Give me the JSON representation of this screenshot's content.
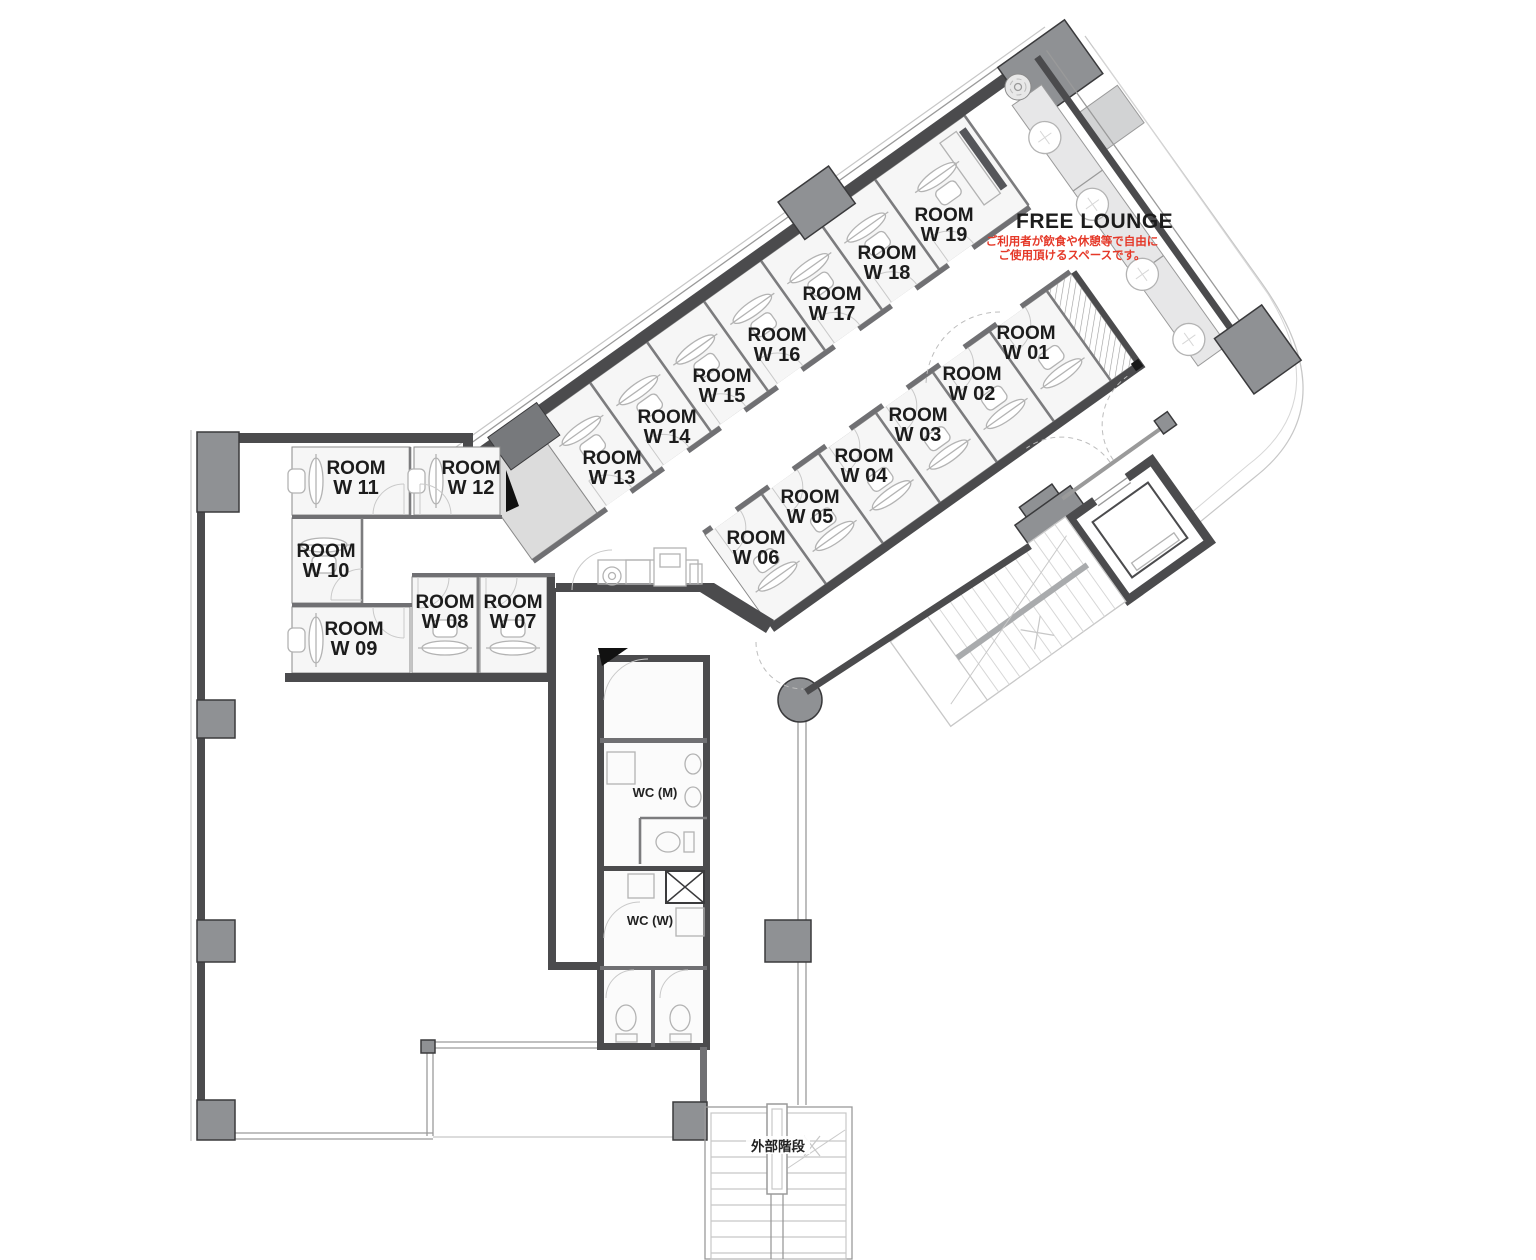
{
  "rooms": [
    {
      "name": "ROOM",
      "number": "W 01"
    },
    {
      "name": "ROOM",
      "number": "W 02"
    },
    {
      "name": "ROOM",
      "number": "W 03"
    },
    {
      "name": "ROOM",
      "number": "W 04"
    },
    {
      "name": "ROOM",
      "number": "W 05"
    },
    {
      "name": "ROOM",
      "number": "W 06"
    },
    {
      "name": "ROOM",
      "number": "W 07"
    },
    {
      "name": "ROOM",
      "number": "W 08"
    },
    {
      "name": "ROOM",
      "number": "W 09"
    },
    {
      "name": "ROOM",
      "number": "W 10"
    },
    {
      "name": "ROOM",
      "number": "W 11"
    },
    {
      "name": "ROOM",
      "number": "W 12"
    },
    {
      "name": "ROOM",
      "number": "W 13"
    },
    {
      "name": "ROOM",
      "number": "W 14"
    },
    {
      "name": "ROOM",
      "number": "W 15"
    },
    {
      "name": "ROOM",
      "number": "W 16"
    },
    {
      "name": "ROOM",
      "number": "W 17"
    },
    {
      "name": "ROOM",
      "number": "W 18"
    },
    {
      "name": "ROOM",
      "number": "W 19"
    }
  ],
  "lounge": {
    "title": "FREE LOUNGE",
    "note_line1": "ご利用者が飲食や休憩等で自由に",
    "note_line2": "ご使用頂けるスペースです。"
  },
  "facilities": {
    "wc_men": "WC (M)",
    "wc_women": "WC (W)",
    "external_stairs": "外部階段"
  },
  "colors": {
    "wall": "#4b4b4d",
    "wall-mid": "#707073",
    "column": "#8f9194",
    "column-border": "#3a3a3c",
    "floor": "#f6f6f6",
    "floor-shaded": "#dcdcdc",
    "bench": "#e7e7e8",
    "line-light": "#c7c7c7",
    "line-mid": "#9a9a9a",
    "furniture": "#b3b3b3",
    "label": "#1c1c1c",
    "annotation-red": "#e53828"
  }
}
